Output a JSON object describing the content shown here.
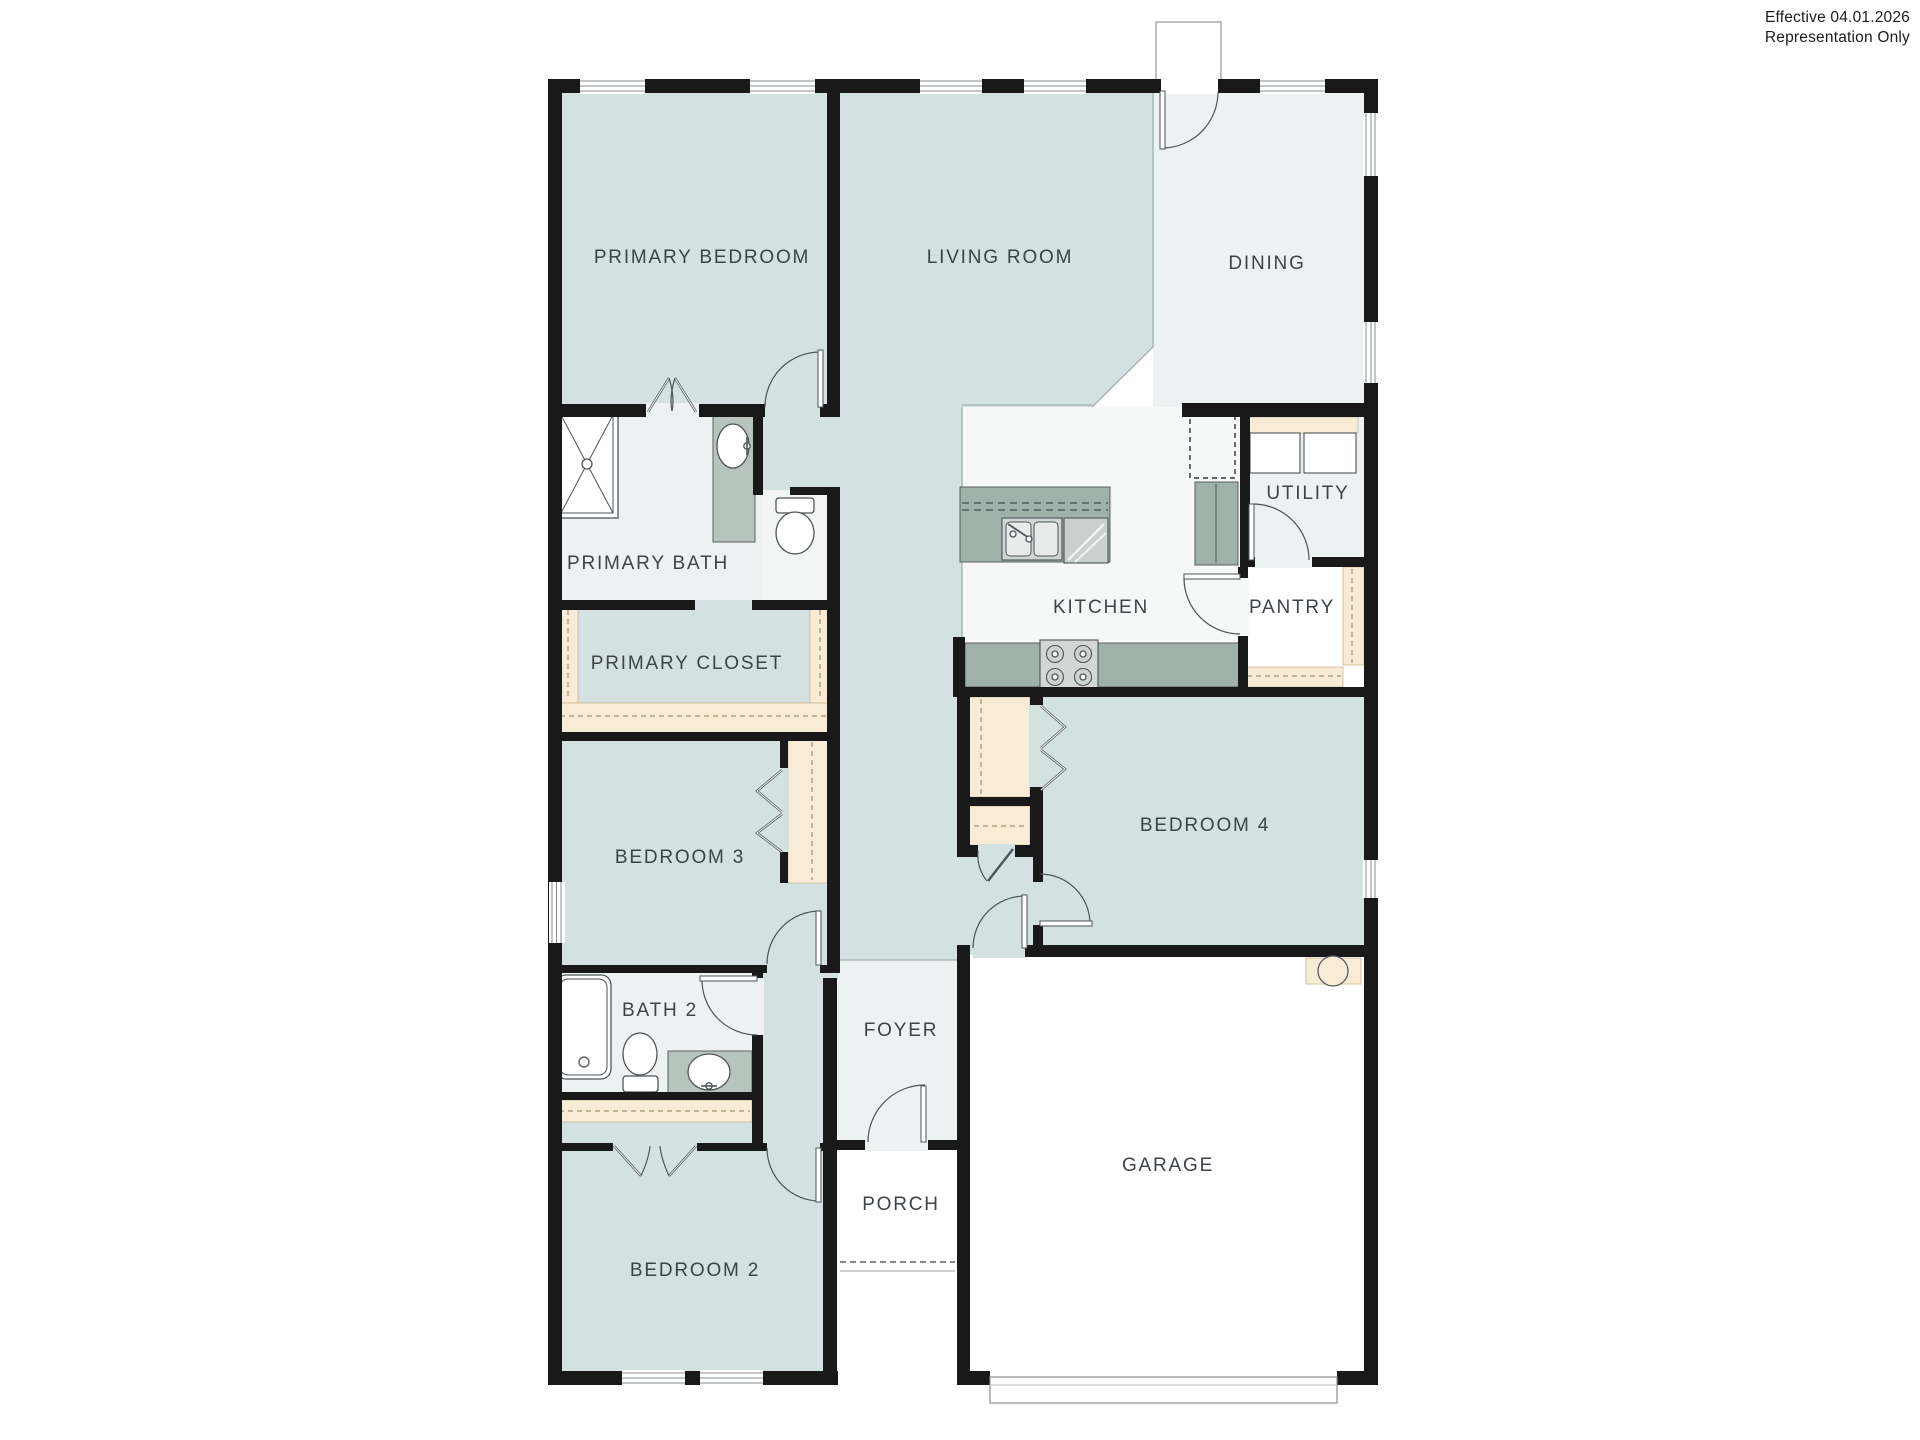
{
  "title_block": {
    "line1": "Effective 04.01.2026",
    "line2": "Representation Only"
  },
  "rooms": [
    {
      "id": "primary-bedroom",
      "label": "PRIMARY BEDROOM"
    },
    {
      "id": "living-room",
      "label": "LIVING ROOM"
    },
    {
      "id": "dining",
      "label": "DINING"
    },
    {
      "id": "primary-bath",
      "label": "PRIMARY BATH"
    },
    {
      "id": "primary-closet",
      "label": "PRIMARY CLOSET"
    },
    {
      "id": "bedroom-3",
      "label": "BEDROOM 3"
    },
    {
      "id": "bath-2",
      "label": "BATH 2"
    },
    {
      "id": "bedroom-2",
      "label": "BEDROOM 2"
    },
    {
      "id": "foyer",
      "label": "FOYER"
    },
    {
      "id": "porch",
      "label": "PORCH"
    },
    {
      "id": "garage",
      "label": "GARAGE"
    },
    {
      "id": "kitchen",
      "label": "KITCHEN"
    },
    {
      "id": "pantry",
      "label": "PANTRY"
    },
    {
      "id": "utility",
      "label": "UTILITY"
    },
    {
      "id": "bedroom-4",
      "label": "BEDROOM 4"
    }
  ],
  "fixtures": [
    "shower",
    "vanity-sink",
    "toilet",
    "bathtub",
    "kitchen-double-sink",
    "dishwasher",
    "stove",
    "refrigerator-space",
    "washer-dryer",
    "water-heater",
    "garage-door",
    "front-stoop"
  ],
  "colors": {
    "wall": "#191919",
    "room-teal": "#d3e1e0",
    "room-gray": "#edf1f1",
    "shelf-tan": "#f8ecd7",
    "counter-sage": "#9fb1a9"
  }
}
